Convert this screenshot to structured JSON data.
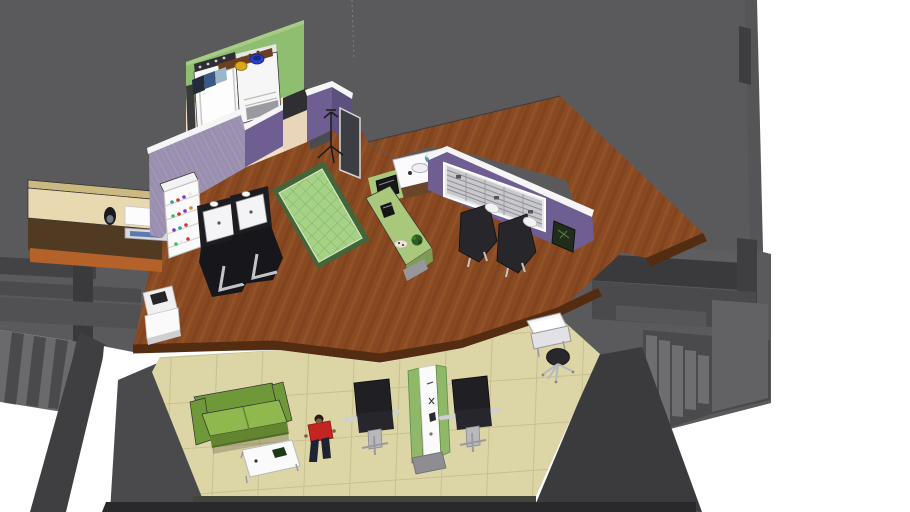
{
  "view": {
    "type": "3d-interior-model-render",
    "subject": "barbershop-salon-apartment-cutaway",
    "camera": "high-angle isometric"
  },
  "colors": {
    "canvas": "#ffffff",
    "backdrop": "#5a5a5c",
    "backdrop_dark": "#3e3e40",
    "beam": "#3a3a3c",
    "beam_mid": "#4a4a4d",
    "beam_light": "#5e5e61",
    "steps": "#6e6e71",
    "steps_dark": "#4a4a4c",
    "wedge": "#3b3b3d",
    "wood": "#8a4a22",
    "wood_dark": "#7b3f1c",
    "wood_light": "#9a5c30",
    "fascia": "#542c12",
    "tile": "#dcd5a5",
    "tile_line": "#c7c08f",
    "green_wall": "#8fbe70",
    "green_wall_top": "#a8cc86",
    "peach_floor": "#f2dfc6",
    "peach_dark": "#e9d6ba",
    "purple_wall": "#6e5e91",
    "purple_dark": "#5d4f7e",
    "lavender_wall": "#9b8fb0",
    "trim_white": "#f5f5f5",
    "rug_border": "#44653a",
    "rug_inner": "#a6d287",
    "rug_lattice": "#7fb35f",
    "desk_top": "#e8d9b0",
    "desk_tier": "#cbb980",
    "desk_front": "#503a22",
    "floor_strip": "#b5622a",
    "green_counter": "#a9c87b",
    "green_counter_side": "#7f9c55",
    "sofa": "#8fb84e",
    "sofa_dark": "#6f9838",
    "appliance": "#f6f6f6",
    "appliance_panel": "#2e2e32",
    "chair_black": "#1d1d21",
    "chair_gray": "#26262b",
    "chrome": "#c4c4c8",
    "stool": "#28282c",
    "person_top": "#c32520",
    "person_pants": "#1c2433",
    "person_skin": "#8a5a3a",
    "person_hair": "#2a1a10",
    "bowl_yellow": "#d8a818",
    "bowl_blue": "#2a3fc8",
    "towel_navy": "#232a3a",
    "towel_blue": "#3a5a85",
    "towel_light": "#9ab6c8",
    "shelf_wood": "#6b3f1f",
    "cup_blue": "#3fa8d8",
    "frame_dark": "#222c1c",
    "register": "#f0f0f2",
    "screen": "#26262a",
    "cubby_inner": "#c9c9cd",
    "glass_door": "#3c3e44",
    "bottles": [
      "#c23a3a",
      "#7a3ac2",
      "#2aa8a0",
      "#e8e8e8",
      "#3ac25a",
      "#d88a20"
    ]
  },
  "objects": [
    {
      "label": "washing machine"
    },
    {
      "label": "dryer"
    },
    {
      "label": "wall shelf with towels and bowls"
    },
    {
      "label": "coat rack"
    },
    {
      "label": "reception desk with phone and card reader"
    },
    {
      "label": "cash register stand"
    },
    {
      "label": "retail product shelf"
    },
    {
      "label": "shampoo backwash station 1"
    },
    {
      "label": "shampoo backwash station 2"
    },
    {
      "label": "area rug"
    },
    {
      "label": "green service desk with phone, plate and plant"
    },
    {
      "label": "manicure sink counter with blue cup"
    },
    {
      "label": "wall cubby shelf unit"
    },
    {
      "label": "styling chair 1"
    },
    {
      "label": "styling chair 2"
    },
    {
      "label": "picture frame"
    },
    {
      "label": "green sofa"
    },
    {
      "label": "white coffee table"
    },
    {
      "label": "person figure"
    },
    {
      "label": "barber chair left"
    },
    {
      "label": "barber chair right"
    },
    {
      "label": "grooming tool cart"
    },
    {
      "label": "instrument tray trolley"
    },
    {
      "label": "rolling stool"
    },
    {
      "label": "left staircase"
    },
    {
      "label": "right staircase"
    },
    {
      "label": "wood platform floor"
    },
    {
      "label": "tiled lower floor"
    },
    {
      "label": "gray shell walls"
    }
  ]
}
